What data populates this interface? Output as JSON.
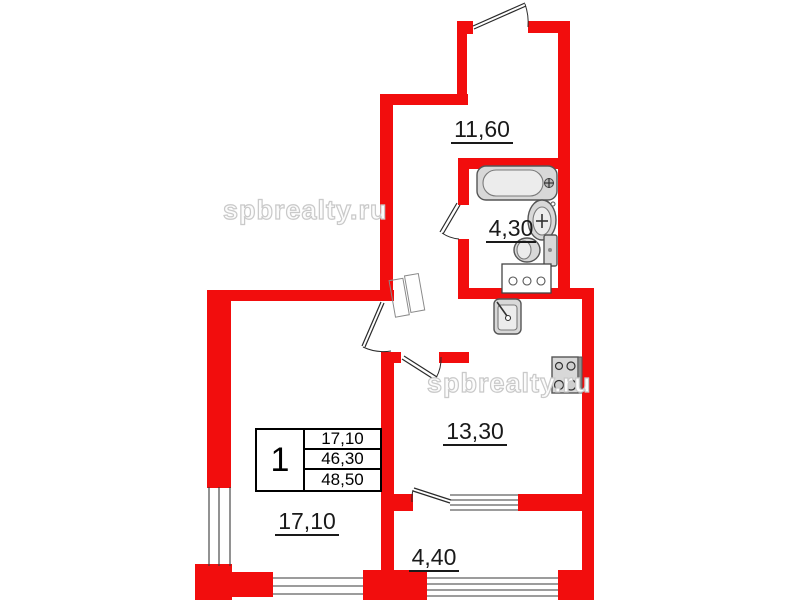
{
  "floor_plan": {
    "watermark": "spbrealty.ru",
    "rooms": {
      "hallway": {
        "area": "11,60"
      },
      "bathroom": {
        "area": "4,30"
      },
      "kitchen": {
        "area": "13,30"
      },
      "living_room": {
        "area": "17,10"
      },
      "balcony": {
        "area": "4,40"
      }
    },
    "info_table": {
      "room_count": "1",
      "rows": [
        "17,10",
        "46,30",
        "48,50"
      ]
    },
    "colors": {
      "wall": "#f20d0d",
      "fixture": "#d8d8d8",
      "outline": "#555555",
      "text": "#1a1a1a"
    }
  }
}
